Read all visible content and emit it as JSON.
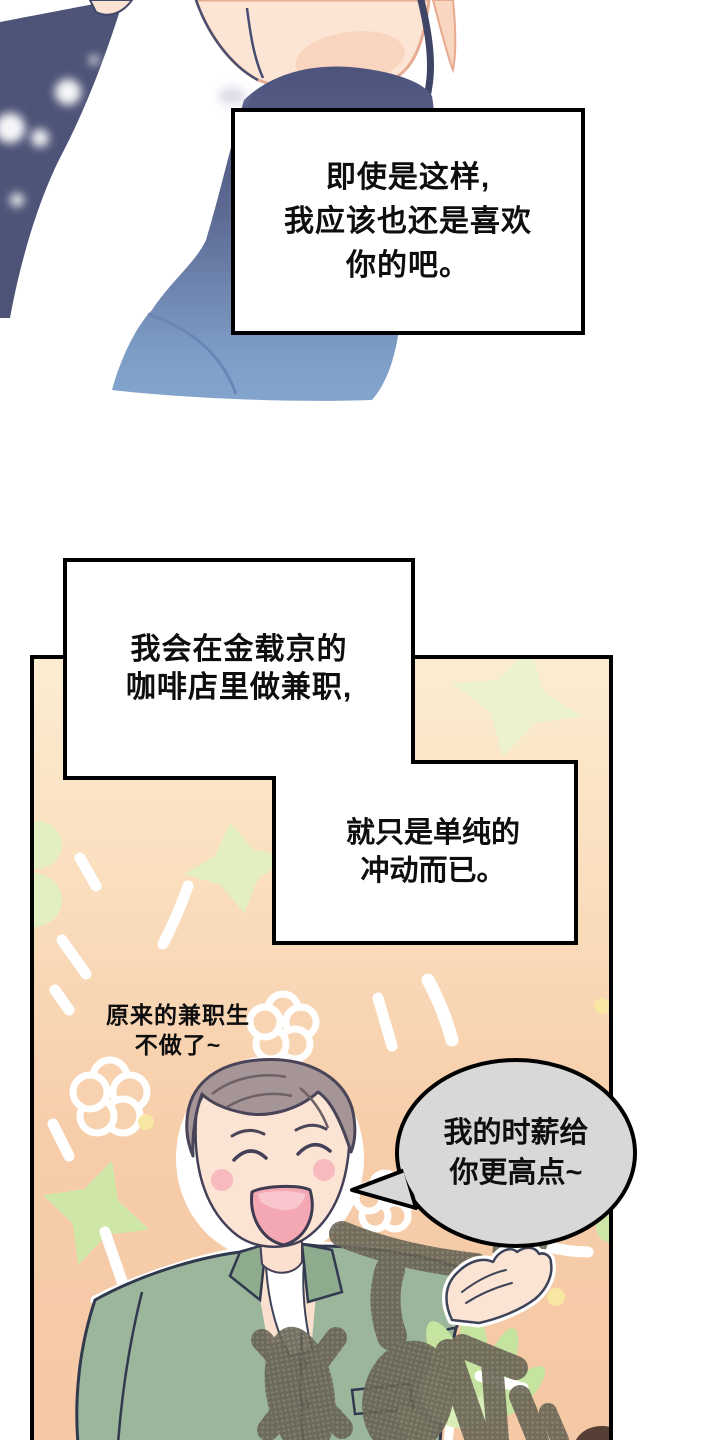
{
  "page": {
    "type": "webtoon-comic-page",
    "background": "#ffffff"
  },
  "panel_top": {
    "narration_box": {
      "lines": [
        "即使是这样,",
        "我应该也还是喜欢",
        "你的吧。"
      ]
    }
  },
  "panel_bottom": {
    "narration_box_1": {
      "lines": [
        "我会在金载京的",
        "咖啡店里做兼职,"
      ]
    },
    "narration_box_2": {
      "lines": [
        "就只是单纯的",
        "冲动而已。"
      ]
    },
    "caption": {
      "lines": [
        "原来的兼职生",
        "不做了~"
      ]
    },
    "speech_bubble": {
      "speaker": "cafe-owner-man",
      "lines": [
        "我的时薪给",
        "你更高点~"
      ]
    }
  },
  "colors": {
    "panel_peach_top": "#fcedd0",
    "panel_peach_bottom": "#f5c8a6",
    "navy_clothing": "#4e5478",
    "steel_blue_clothing": "#7f9fc9",
    "skin": "#fce4d4",
    "skin_outline_salmon": "#efae96",
    "hair_gray_mauve": "#a59597",
    "shirt_sage_green": "#9cb69b",
    "bubble_gray": "#d8d8d9",
    "star_pale_green": "#e9f1ca",
    "sprout_green": "#c5e4a0",
    "stamp_olive": "#676253",
    "outline_black": "#000000",
    "blush_pink": "#f5b3bb",
    "mouth_pink": "#f3a8b4"
  }
}
